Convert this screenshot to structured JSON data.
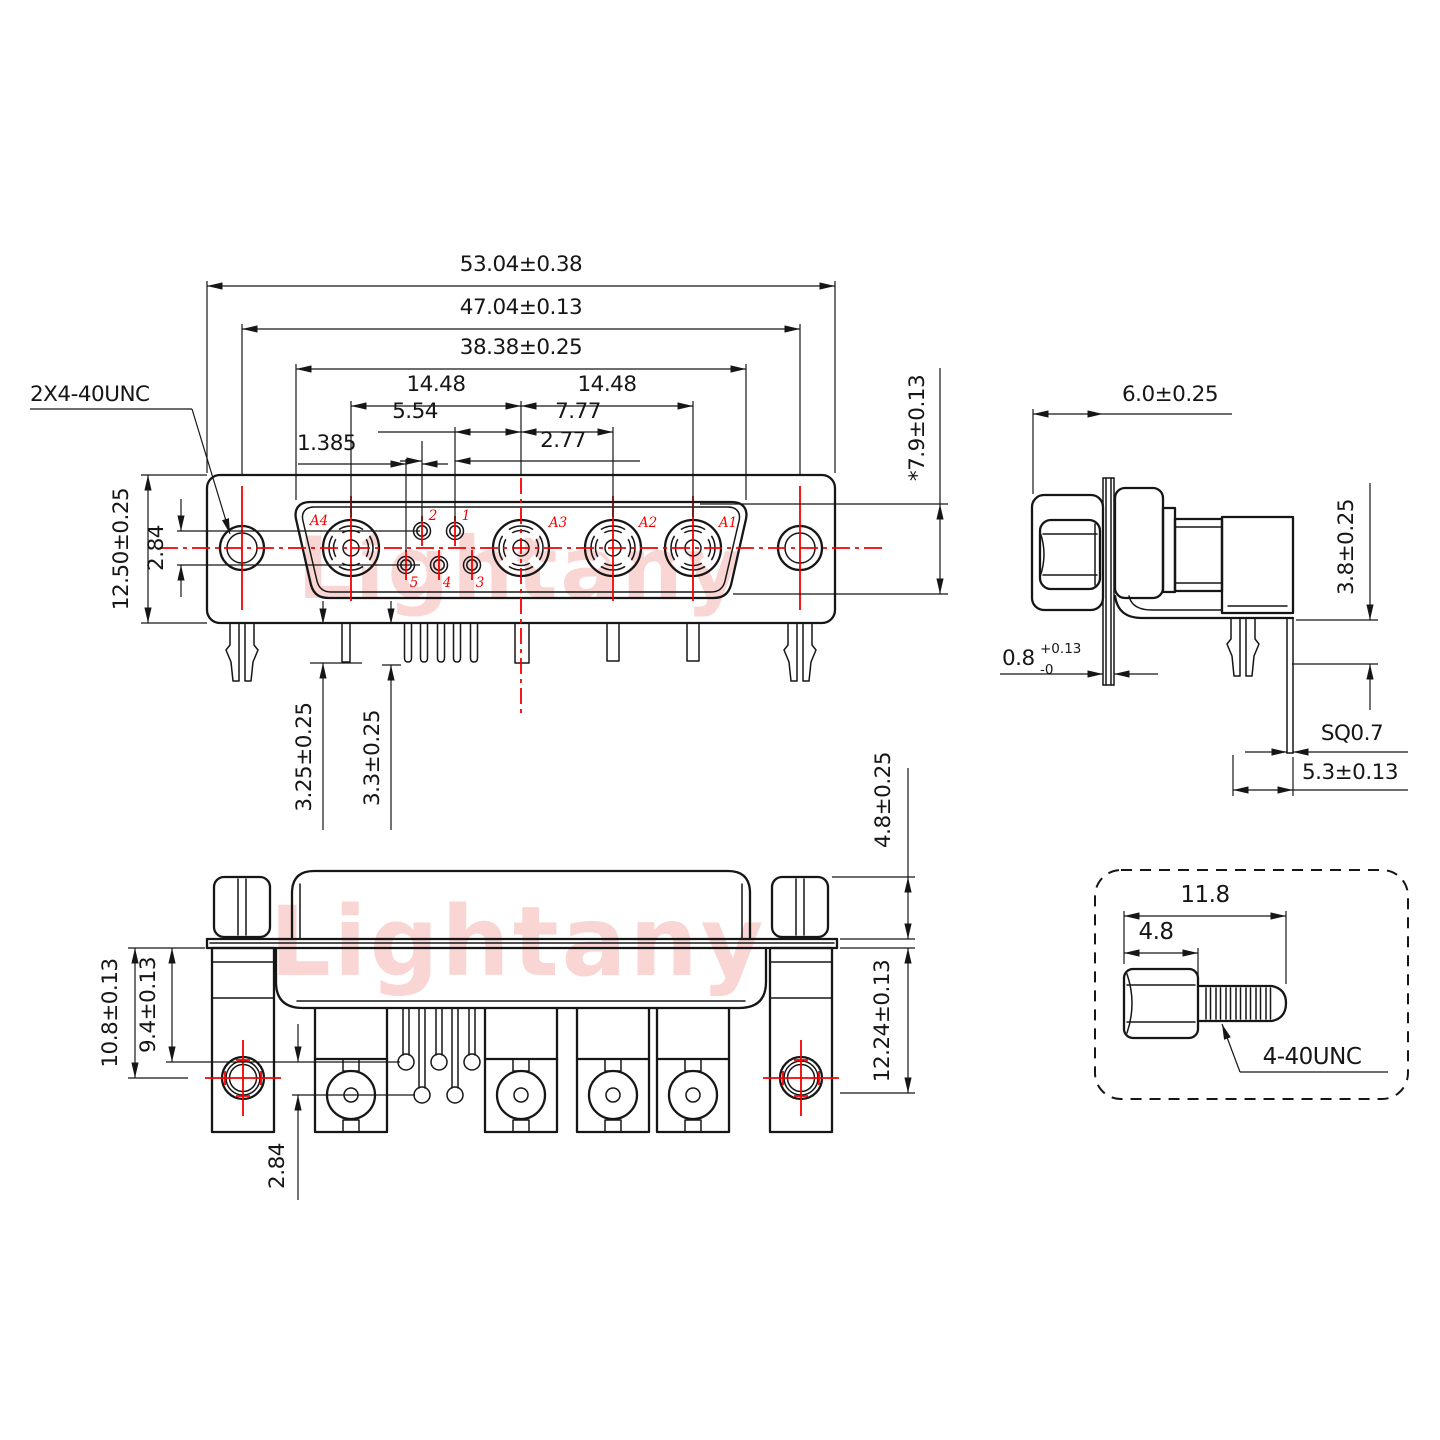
{
  "watermark": {
    "text": "Lightany",
    "color": "#f8cbca"
  },
  "colors": {
    "line": "#161616",
    "accent": "#f40000"
  },
  "front_view": {
    "thread_note": "2X4-40UNC",
    "dims": {
      "overall_width": "53.04±0.38",
      "mount_span": "47.04±0.13",
      "cutout_width": "38.38±0.25",
      "pitch_left": "14.48",
      "pitch_right": "14.48",
      "pin_to_center": "5.54",
      "center_to_a2": "7.77",
      "pin_pitch": "2.77",
      "row_stagger": "1.385",
      "row_gap": "2.84",
      "body_height": "12.50±0.25",
      "cutout_height": "*7.9±0.13",
      "leg_len_a": "3.25±0.25",
      "leg_len_b": "3.3±0.25"
    },
    "contacts": {
      "a1": "A1",
      "a2": "A2",
      "a3": "A3",
      "a4": "A4"
    },
    "pins": {
      "p1": "1",
      "p2": "2",
      "p3": "3",
      "p4": "4",
      "p5": "5"
    }
  },
  "side_view": {
    "dims": {
      "front_depth": "6.0±0.25",
      "flange_val": "0.8",
      "flange_sup": "+0.13",
      "flange_sub": "-0",
      "standoff": "3.8±0.25",
      "pin_square": "SQ0.7",
      "tail_pitch": "5.3±0.13"
    }
  },
  "rear_view": {
    "dims": {
      "mount_center": "10.8±0.13",
      "pin_row": "9.4±0.13",
      "row_gap": "2.84",
      "tail_plane": "12.24±0.13",
      "nut_height": "4.8±0.25"
    }
  },
  "screw_detail": {
    "dims": {
      "total_len": "11.8",
      "head_len": "4.8"
    },
    "thread_label": "4-40UNC"
  }
}
